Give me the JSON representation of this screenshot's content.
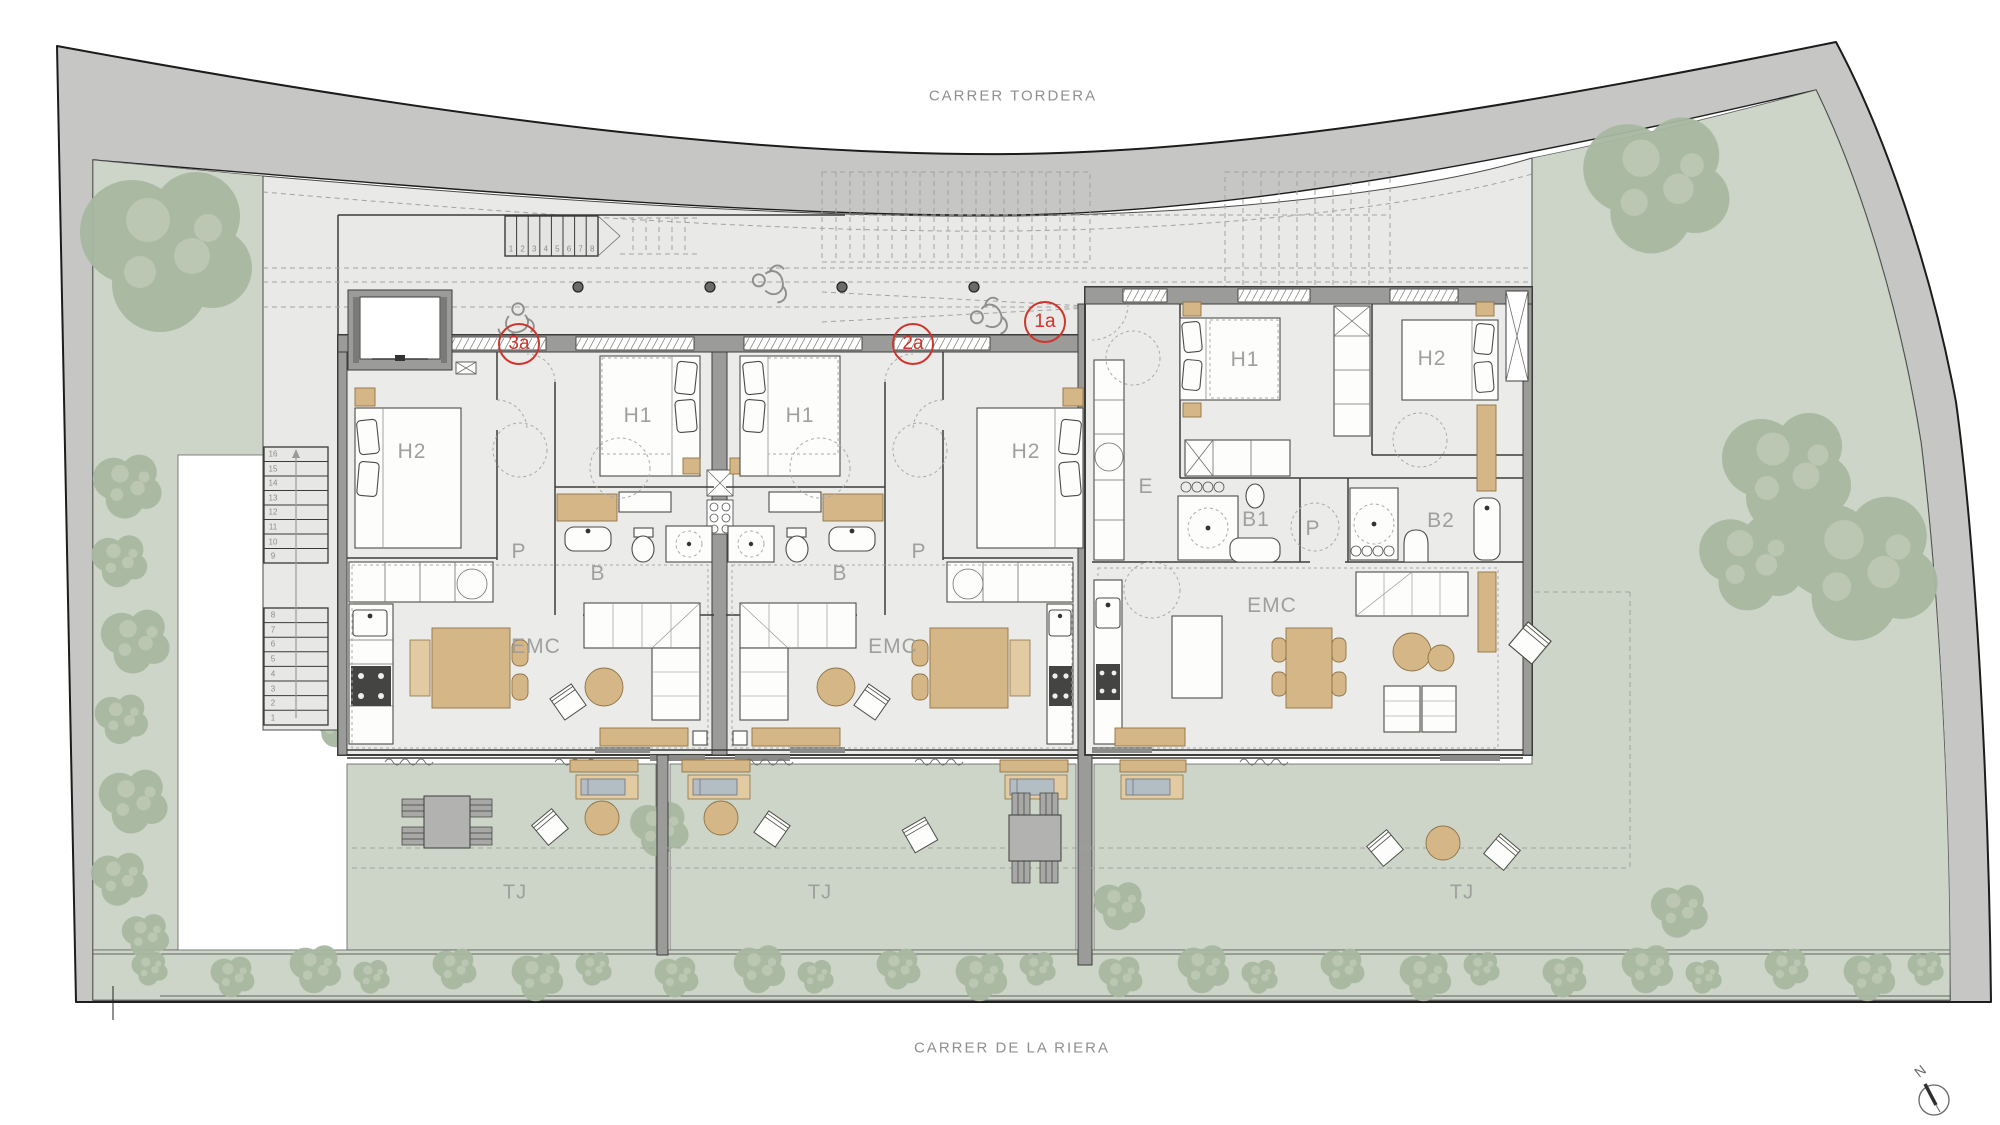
{
  "plan": {
    "street_top": "CARRER TORDERA",
    "street_bottom": "CARRER DE LA RIERA",
    "north_label": "N",
    "unit_badges": [
      {
        "text": "3a",
        "x": 519,
        "y": 344
      },
      {
        "text": "2a",
        "x": 913,
        "y": 344
      },
      {
        "text": "1a",
        "x": 1045,
        "y": 322
      }
    ],
    "room_labels": [
      {
        "text": "H2",
        "x": 412,
        "y": 452
      },
      {
        "text": "H1",
        "x": 638,
        "y": 416
      },
      {
        "text": "P",
        "x": 519,
        "y": 552
      },
      {
        "text": "B",
        "x": 598,
        "y": 574
      },
      {
        "text": "EMC",
        "x": 536,
        "y": 647
      },
      {
        "text": "H1",
        "x": 800,
        "y": 416
      },
      {
        "text": "H2",
        "x": 1026,
        "y": 452
      },
      {
        "text": "P",
        "x": 919,
        "y": 552
      },
      {
        "text": "B",
        "x": 840,
        "y": 574
      },
      {
        "text": "EMC",
        "x": 893,
        "y": 647
      },
      {
        "text": "E",
        "x": 1146,
        "y": 487
      },
      {
        "text": "H1",
        "x": 1245,
        "y": 360
      },
      {
        "text": "H2",
        "x": 1432,
        "y": 359
      },
      {
        "text": "B1",
        "x": 1256,
        "y": 520
      },
      {
        "text": "P",
        "x": 1313,
        "y": 529
      },
      {
        "text": "B2",
        "x": 1441,
        "y": 521
      },
      {
        "text": "EMC",
        "x": 1272,
        "y": 606
      }
    ],
    "terrace_labels": [
      {
        "text": "TJ",
        "x": 515,
        "y": 893
      },
      {
        "text": "TJ",
        "x": 820,
        "y": 893
      },
      {
        "text": "TJ",
        "x": 1462,
        "y": 893
      }
    ],
    "stairs": {
      "top": [
        "1",
        "2",
        "3",
        "4",
        "5",
        "6",
        "7",
        "8"
      ],
      "left_upper": [
        "16",
        "15",
        "14",
        "13",
        "12",
        "11",
        "10",
        "9"
      ],
      "left_lower": [
        "8",
        "7",
        "6",
        "5",
        "4",
        "3",
        "2",
        "1"
      ]
    },
    "colors": {
      "accent_red": "#cf352c",
      "garden_green": "#cdd5c8",
      "tree_green": "#a7b8a1",
      "street_gray": "#c6c6c4",
      "wall_dark": "#3c3c3a",
      "wood_tan": "#d5b687",
      "label_gray": "#9f9f9d"
    }
  }
}
